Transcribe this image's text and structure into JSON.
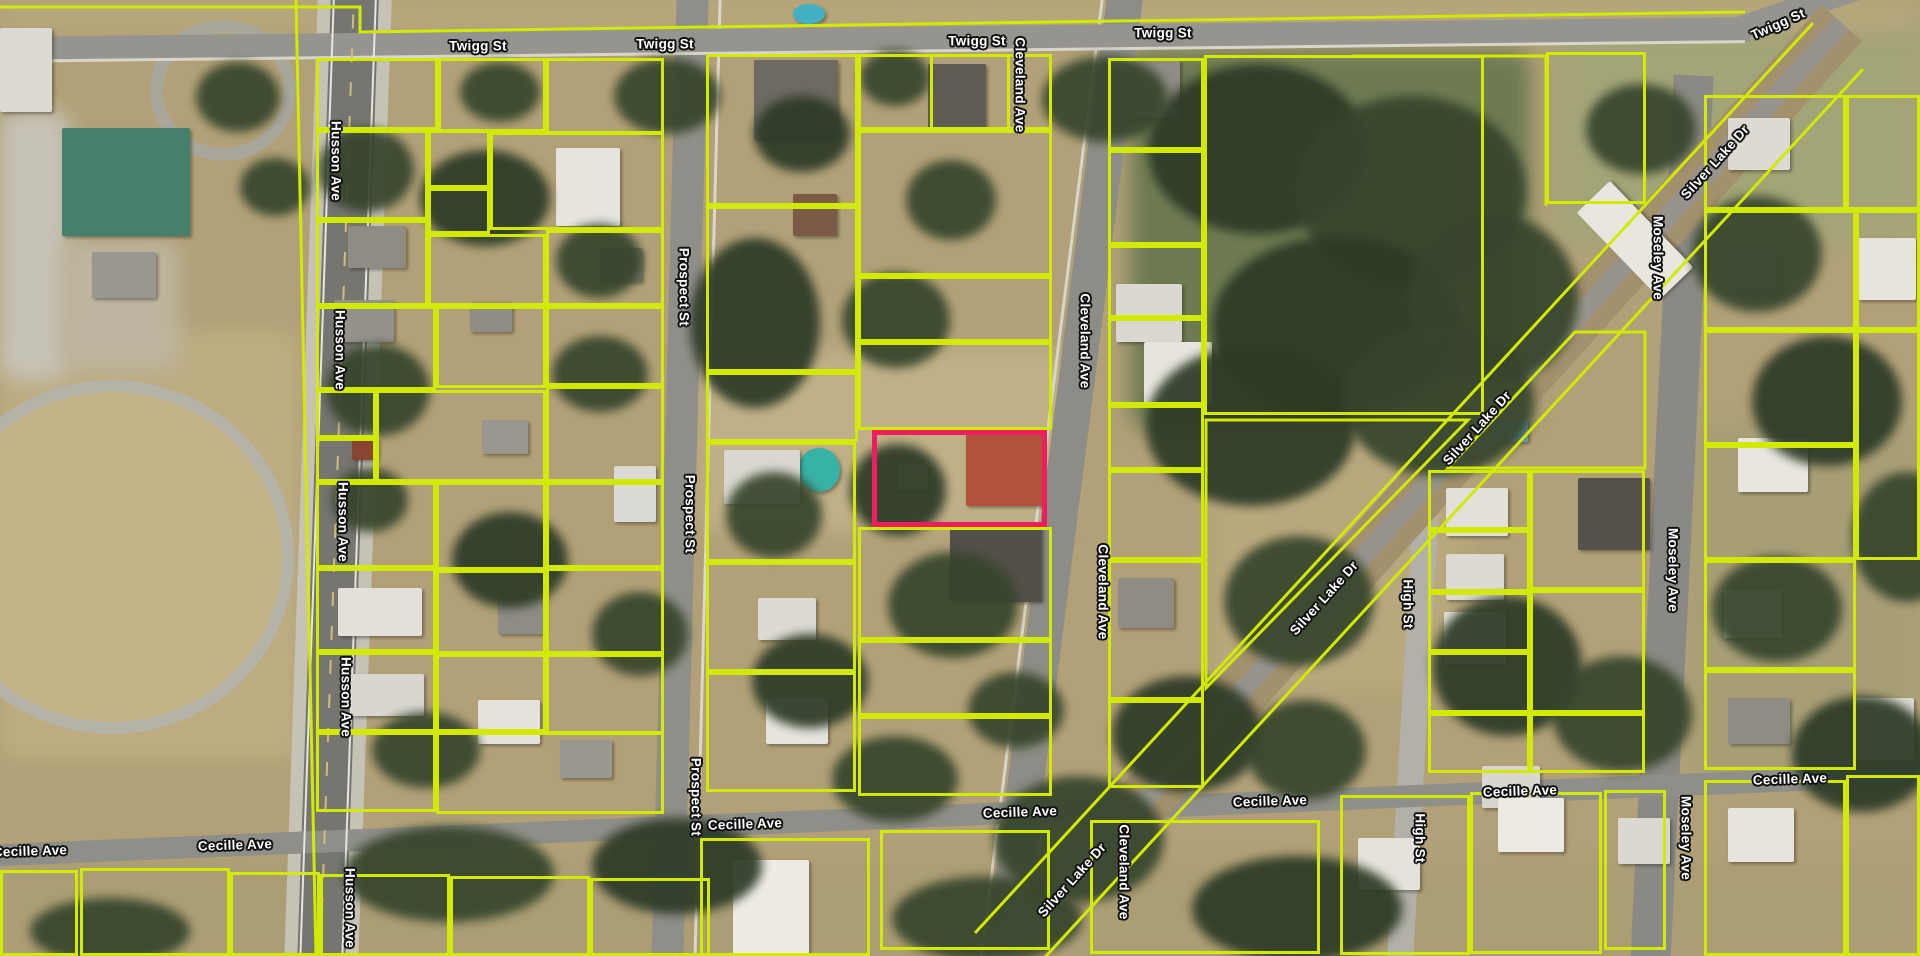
{
  "map": {
    "type": "aerial-parcel-map",
    "parcel_line_color": "#d2ea00",
    "selected_parcel_color": "#ee1d5e",
    "street_labels": [
      {
        "text": "Twigg St",
        "x": 478,
        "y": 46
      },
      {
        "text": "Twigg St",
        "x": 665,
        "y": 44
      },
      {
        "text": "Twigg St",
        "x": 977,
        "y": 41
      },
      {
        "text": "Twigg St",
        "x": 1163,
        "y": 33
      },
      {
        "text": "Twigg St",
        "x": 1778,
        "y": 24,
        "rot": -24
      },
      {
        "text": "Husson Ave",
        "x": 336,
        "y": 161,
        "vert": true
      },
      {
        "text": "Husson Ave",
        "x": 340,
        "y": 350,
        "vert": true
      },
      {
        "text": "Husson Ave",
        "x": 343,
        "y": 522,
        "vert": true
      },
      {
        "text": "Husson Ave",
        "x": 346,
        "y": 697,
        "vert": true
      },
      {
        "text": "Husson Ave",
        "x": 350,
        "y": 908,
        "vert": true
      },
      {
        "text": "Prospect St",
        "x": 684,
        "y": 287,
        "vert": true
      },
      {
        "text": "Prospect St",
        "x": 690,
        "y": 514,
        "vert": true
      },
      {
        "text": "Prospect St",
        "x": 696,
        "y": 797,
        "vert": true
      },
      {
        "text": "Cleveland Ave",
        "x": 1020,
        "y": 85,
        "vert": true
      },
      {
        "text": "Cleveland Ave",
        "x": 1085,
        "y": 341,
        "vert": true
      },
      {
        "text": "Cleveland Ave",
        "x": 1103,
        "y": 592,
        "vert": true
      },
      {
        "text": "Cleveland Ave",
        "x": 1124,
        "y": 872,
        "vert": true
      },
      {
        "text": "High St",
        "x": 1408,
        "y": 604,
        "vert": true
      },
      {
        "text": "High St",
        "x": 1420,
        "y": 838,
        "vert": true
      },
      {
        "text": "Moseley Ave",
        "x": 1658,
        "y": 258,
        "vert": true
      },
      {
        "text": "Moseley Ave",
        "x": 1673,
        "y": 570,
        "vert": true
      },
      {
        "text": "Moseley Ave",
        "x": 1686,
        "y": 838,
        "vert": true
      },
      {
        "text": "Silver Lake Dr",
        "x": 1715,
        "y": 162,
        "rot": -48
      },
      {
        "text": "Silver Lake Dr",
        "x": 1477,
        "y": 428,
        "rot": -48
      },
      {
        "text": "Silver Lake Dr",
        "x": 1324,
        "y": 598,
        "rot": -48
      },
      {
        "text": "Silver Lake Dr",
        "x": 1072,
        "y": 880,
        "rot": -48
      },
      {
        "text": "Cecille Ave",
        "x": 30,
        "y": 851,
        "rot": -2
      },
      {
        "text": "Cecille Ave",
        "x": 235,
        "y": 845,
        "rot": -2
      },
      {
        "text": "Cecille Ave",
        "x": 745,
        "y": 824,
        "rot": -2
      },
      {
        "text": "Cecille Ave",
        "x": 1020,
        "y": 812,
        "rot": -2
      },
      {
        "text": "Cecille Ave",
        "x": 1270,
        "y": 801,
        "rot": -2
      },
      {
        "text": "Cecille Ave",
        "x": 1520,
        "y": 791,
        "rot": -2
      },
      {
        "text": "Cecille Ave",
        "x": 1790,
        "y": 779,
        "rot": -2
      }
    ]
  }
}
